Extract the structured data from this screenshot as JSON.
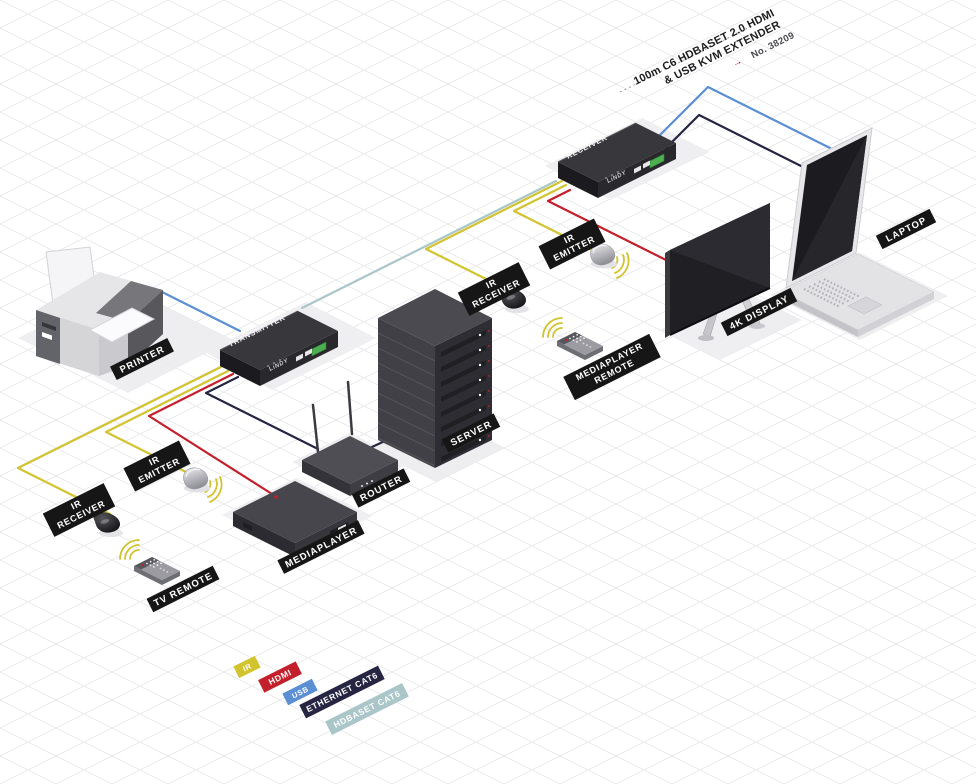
{
  "title": {
    "line1": "100m C6 HDBASET 2.0 HDMI",
    "line2": "& USB KVM EXTENDER",
    "arrow": "→",
    "product_no": "No. 38209"
  },
  "devices": {
    "transmitter": {
      "label": "TRANSMITTER",
      "brand": "LiNDY"
    },
    "receiver": {
      "label": "RECEIVER",
      "brand": "LiNDY"
    },
    "printer": {
      "label": "PRINTER"
    },
    "laptop": {
      "label": "LAPTOP"
    },
    "display": {
      "label": "4K DISPLAY"
    },
    "server": {
      "label": "SERVER"
    },
    "router": {
      "label": "ROUTER"
    },
    "mediaplayer": {
      "label": "MEDIAPLAYER"
    },
    "tv_remote": {
      "label": "TV REMOTE"
    },
    "mp_remote": {
      "line1": "MEDIAPLAYER",
      "line2": "REMOTE"
    },
    "ir_receiver": {
      "line1": "IR",
      "line2": "RECEIVER"
    },
    "ir_emitter": {
      "line1": "IR",
      "line2": "EMITTER"
    }
  },
  "legend": {
    "items": [
      {
        "label": "IR",
        "color": "#d2c42e"
      },
      {
        "label": "HDMI",
        "color": "#c3202c"
      },
      {
        "label": "USB",
        "color": "#5b8fd3"
      },
      {
        "label": "ETHERNET CAT6",
        "color": "#262643"
      },
      {
        "label": "HDBASET CAT6",
        "color": "#aac6c9"
      }
    ]
  },
  "wires": {
    "ir": "#d2c42e",
    "hdmi": "#c3202c",
    "usb": "#5b8fd3",
    "ethernet": "#262643",
    "hdbaset": "#aac6c9"
  }
}
